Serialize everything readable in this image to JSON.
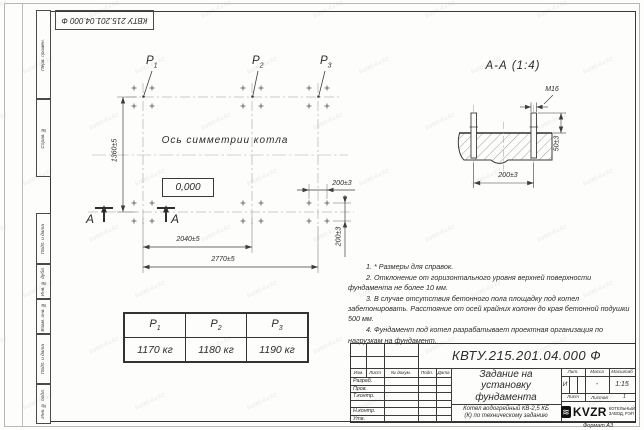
{
  "sheet": {
    "watermark": "kotel-kv.kz",
    "stamp_top": "КВТУ 215.201.04.000 Ф",
    "format": "Формат А3"
  },
  "margin": {
    "top": [
      "Перв. примен.",
      "Справ. №"
    ],
    "bottom": [
      "Подп. и дата",
      "Инв. № дубл.",
      "Взам. инв. №",
      "Подп. и дата",
      "Инв. № подл."
    ]
  },
  "plan": {
    "points": [
      {
        "name": "P",
        "sub": "1"
      },
      {
        "name": "P",
        "sub": "2"
      },
      {
        "name": "P",
        "sub": "3"
      }
    ],
    "axis_label": "Ось симметрии котла",
    "level": "0,000",
    "dim_height": "1360±5",
    "dim_width_inner": "2040±5",
    "dim_width_outer": "2770±5",
    "dim_bolt_h": "200±3",
    "dim_bolt_v": "200±3",
    "section_letter_left": "А",
    "section_letter_right": "А"
  },
  "section": {
    "title": "А-А (1:4)",
    "thread": "М16",
    "dim_height": "50±3",
    "dim_width": "200±3"
  },
  "load_table": {
    "headers": [
      {
        "name": "P",
        "sub": "1"
      },
      {
        "name": "P",
        "sub": "2"
      },
      {
        "name": "P",
        "sub": "3"
      }
    ],
    "values": [
      "1170  кг",
      "1180  кг",
      "1190  кг"
    ]
  },
  "notes": [
    "1.  * Размеры для справок.",
    "2.  Отклонение от горизонтального уровня верхней поверхности фундамента не более 10 мм.",
    "3.  В случае отсутствия бетонного пола площадку под котел забетонировать. Расстояние от осей крайних колонн до края бетонной подушки 500 мм.",
    "4.  Фундамент под котел разрабатывает проектная организация по нагрузкам на фундамент."
  ],
  "title_block": {
    "doc_number": "КВТУ.215.201.04.000  Ф",
    "title": "Задание на установку фундамента",
    "subtitle": "Котел водогрейный КВ-2,5 КБ (К) по техническому заданию",
    "header_cols": [
      "Изм.",
      "Лист",
      "№ докум.",
      "Подп.",
      "Дата"
    ],
    "rows": [
      "Разраб.",
      "Пров.",
      "Т.контр.",
      "",
      "Н.контр.",
      "Утв."
    ],
    "lit_labels": [
      "Лит.",
      "Масса",
      "Масштаб"
    ],
    "lit_values": [
      "И",
      "-",
      "1:15"
    ],
    "sheet_label": "Лист",
    "sheets_label": "Листов",
    "sheets_value": "1",
    "logo_text": "KVZR",
    "logo_caption_1": "КОТЕЛЬНЫЙ",
    "logo_caption_2": "ЗАВОД, РЭП"
  }
}
